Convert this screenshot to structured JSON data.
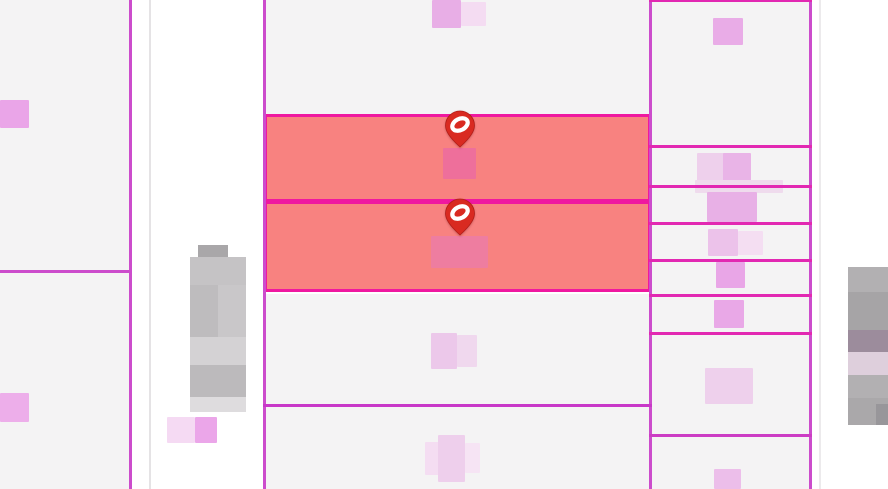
{
  "map": {
    "description": "cadastral-parcel-map",
    "canvas": {
      "width": 888,
      "height": 489,
      "background": "#ffffff"
    },
    "colors": {
      "parcel_fill": "#f4f3f4",
      "selected_fill": "#f88280",
      "selected_border": "#ef18a0",
      "boundary_purple": "#cc4ccc",
      "boundary_bright": "#e228b2",
      "faint_gray_line": "#e5e3e5",
      "marker_red": "#d92a21",
      "marker_outline": "#b01d18",
      "marker_glyph": "#ffffff"
    },
    "selected_count": 2,
    "parcels": [
      {
        "name": "parcel",
        "x": 0,
        "y": 0,
        "w": 129,
        "h": 270,
        "fill": "#f4f3f4",
        "selected": false
      },
      {
        "name": "parcel",
        "x": 0,
        "y": 273,
        "w": 129,
        "h": 216,
        "fill": "#f4f3f4",
        "selected": false
      },
      {
        "name": "parcel",
        "x": 266,
        "y": 0,
        "w": 383,
        "h": 114,
        "fill": "#f4f3f4",
        "selected": false
      },
      {
        "name": "selected-parcel",
        "x": 264,
        "y": 114,
        "w": 387,
        "h": 88,
        "fill": "#f88280",
        "selected": true,
        "border": "#ef18a0"
      },
      {
        "name": "selected-parcel",
        "x": 264,
        "y": 201,
        "w": 387,
        "h": 91,
        "fill": "#f88280",
        "selected": true,
        "border": "#ef18a0"
      },
      {
        "name": "parcel",
        "x": 266,
        "y": 294,
        "w": 383,
        "h": 110,
        "fill": "#f4f3f4",
        "selected": false
      },
      {
        "name": "parcel",
        "x": 266,
        "y": 407,
        "w": 383,
        "h": 82,
        "fill": "#f4f3f4",
        "selected": false
      },
      {
        "name": "parcel",
        "x": 652,
        "y": 2,
        "w": 157,
        "h": 143,
        "fill": "#f4f3f4",
        "selected": false
      },
      {
        "name": "parcel",
        "x": 652,
        "y": 148,
        "w": 157,
        "h": 37,
        "fill": "#f4f3f4",
        "selected": false
      },
      {
        "name": "parcel",
        "x": 652,
        "y": 188,
        "w": 157,
        "h": 34,
        "fill": "#f4f3f4",
        "selected": false
      },
      {
        "name": "parcel",
        "x": 652,
        "y": 225,
        "w": 157,
        "h": 34,
        "fill": "#f4f3f4",
        "selected": false
      },
      {
        "name": "parcel",
        "x": 652,
        "y": 262,
        "w": 157,
        "h": 32,
        "fill": "#f4f3f4",
        "selected": false
      },
      {
        "name": "parcel",
        "x": 652,
        "y": 297,
        "w": 157,
        "h": 35,
        "fill": "#f4f3f4",
        "selected": false
      },
      {
        "name": "parcel",
        "x": 652,
        "y": 335,
        "w": 157,
        "h": 99,
        "fill": "#f4f3f4",
        "selected": false
      },
      {
        "name": "parcel",
        "x": 652,
        "y": 437,
        "w": 157,
        "h": 52,
        "fill": "#f4f3f4",
        "selected": false
      }
    ],
    "boundary_lines": [
      {
        "name": "boundary-line",
        "x": 129,
        "y": 0,
        "w": 3,
        "h": 489,
        "color": "#cc4ccc"
      },
      {
        "name": "boundary-line-faint",
        "x": 149,
        "y": 0,
        "w": 2,
        "h": 489,
        "color": "#e5e3e5"
      },
      {
        "name": "boundary-line",
        "x": 263,
        "y": 0,
        "w": 3,
        "h": 489,
        "color": "#cc4ccc"
      },
      {
        "name": "boundary-line",
        "x": 649,
        "y": 0,
        "w": 3,
        "h": 489,
        "color": "#cc4ccc"
      },
      {
        "name": "boundary-line",
        "x": 809,
        "y": 0,
        "w": 3,
        "h": 489,
        "color": "#cc4ccc"
      },
      {
        "name": "boundary-line-faint",
        "x": 819,
        "y": 0,
        "w": 2,
        "h": 489,
        "color": "#eceaec"
      },
      {
        "name": "boundary-line",
        "x": 0,
        "y": 270,
        "w": 131,
        "h": 3,
        "color": "#cc4ccc"
      },
      {
        "name": "boundary-line",
        "x": 263,
        "y": 404,
        "w": 389,
        "h": 3,
        "color": "#c837c8"
      },
      {
        "name": "boundary-line",
        "x": 649,
        "y": 0,
        "w": 163,
        "h": 2,
        "color": "#e228b2"
      },
      {
        "name": "boundary-line",
        "x": 649,
        "y": 145,
        "w": 163,
        "h": 3,
        "color": "#e228b2"
      },
      {
        "name": "boundary-line",
        "x": 649,
        "y": 185,
        "w": 163,
        "h": 3,
        "color": "#e228b2"
      },
      {
        "name": "boundary-line",
        "x": 649,
        "y": 222,
        "w": 163,
        "h": 3,
        "color": "#e228b2"
      },
      {
        "name": "boundary-line",
        "x": 649,
        "y": 259,
        "w": 163,
        "h": 3,
        "color": "#e228b2"
      },
      {
        "name": "boundary-line",
        "x": 649,
        "y": 294,
        "w": 163,
        "h": 3,
        "color": "#e228b2"
      },
      {
        "name": "boundary-line",
        "x": 649,
        "y": 332,
        "w": 163,
        "h": 3,
        "color": "#e228b2"
      },
      {
        "name": "boundary-line",
        "x": 649,
        "y": 434,
        "w": 163,
        "h": 3,
        "color": "#cc3cc4"
      }
    ],
    "redacted_parcel_labels": [
      {
        "name": "parcel-label-redacted",
        "x": 0,
        "y": 100,
        "w": 29,
        "h": 28,
        "color": "#eaa5e8"
      },
      {
        "name": "parcel-label-redacted",
        "x": 0,
        "y": 393,
        "w": 29,
        "h": 29,
        "color": "#edaeea"
      },
      {
        "name": "parcel-label-redacted",
        "x": 432,
        "y": 0,
        "w": 29,
        "h": 28,
        "color": "#e8aee6"
      },
      {
        "name": "parcel-label-redacted",
        "x": 461,
        "y": 2,
        "w": 25,
        "h": 24,
        "color": "#f4dcf2"
      },
      {
        "name": "parcel-label-redacted",
        "x": 443,
        "y": 148,
        "w": 33,
        "h": 31,
        "color": "#ee6f9b"
      },
      {
        "name": "parcel-label-redacted",
        "x": 431,
        "y": 236,
        "w": 57,
        "h": 32,
        "color": "#ee7da0"
      },
      {
        "name": "parcel-label-redacted",
        "x": 431,
        "y": 333,
        "w": 26,
        "h": 36,
        "color": "#ecc8ea"
      },
      {
        "name": "parcel-label-redacted",
        "x": 457,
        "y": 335,
        "w": 20,
        "h": 32,
        "color": "#f0d8ee"
      },
      {
        "name": "parcel-label-redacted",
        "x": 425,
        "y": 442,
        "w": 14,
        "h": 33,
        "color": "#f4ddf2"
      },
      {
        "name": "parcel-label-redacted",
        "x": 438,
        "y": 435,
        "w": 27,
        "h": 47,
        "color": "#eecfec"
      },
      {
        "name": "parcel-label-redacted",
        "x": 465,
        "y": 443,
        "w": 15,
        "h": 30,
        "color": "#f6e4f4"
      },
      {
        "name": "parcel-label-redacted",
        "x": 713,
        "y": 18,
        "w": 30,
        "h": 27,
        "color": "#e9ace7"
      },
      {
        "name": "parcel-label-redacted",
        "x": 697,
        "y": 153,
        "w": 27,
        "h": 30,
        "color": "#eed0ec"
      },
      {
        "name": "parcel-label-redacted",
        "x": 723,
        "y": 153,
        "w": 28,
        "h": 31,
        "color": "#e9b4e7"
      },
      {
        "name": "parcel-label-redacted",
        "x": 695,
        "y": 180,
        "w": 88,
        "h": 13,
        "color": "#efdbed"
      },
      {
        "name": "parcel-label-redacted",
        "x": 707,
        "y": 192,
        "w": 50,
        "h": 30,
        "color": "#e8b0e6"
      },
      {
        "name": "parcel-label-redacted",
        "x": 708,
        "y": 229,
        "w": 30,
        "h": 27,
        "color": "#ecc2ea"
      },
      {
        "name": "parcel-label-redacted",
        "x": 738,
        "y": 231,
        "w": 25,
        "h": 24,
        "color": "#f4def2"
      },
      {
        "name": "parcel-label-redacted",
        "x": 716,
        "y": 262,
        "w": 29,
        "h": 26,
        "color": "#e9a6e7"
      },
      {
        "name": "parcel-label-redacted",
        "x": 714,
        "y": 300,
        "w": 30,
        "h": 28,
        "color": "#e9a8e7"
      },
      {
        "name": "parcel-label-redacted",
        "x": 705,
        "y": 368,
        "w": 48,
        "h": 36,
        "color": "#eed0ec"
      },
      {
        "name": "parcel-label-redacted",
        "x": 714,
        "y": 469,
        "w": 27,
        "h": 20,
        "color": "#ecbeea"
      },
      {
        "name": "parcel-label-redacted",
        "x": 167,
        "y": 417,
        "w": 28,
        "h": 26,
        "color": "#f5daf3"
      },
      {
        "name": "parcel-label-redacted",
        "x": 195,
        "y": 417,
        "w": 22,
        "h": 26,
        "color": "#eba6e9"
      }
    ],
    "redacted_text_blocks": [
      {
        "name": "redacted-text-block",
        "x": 198,
        "y": 245,
        "w": 30,
        "h": 12,
        "color": "#a9a7a9"
      },
      {
        "name": "redacted-text-block",
        "x": 190,
        "y": 257,
        "w": 56,
        "h": 28,
        "color": "#c5c3c5"
      },
      {
        "name": "redacted-text-block",
        "x": 190,
        "y": 285,
        "w": 56,
        "h": 52,
        "color": "#c9c7c9"
      },
      {
        "name": "redacted-text-block",
        "x": 190,
        "y": 285,
        "w": 28,
        "h": 52,
        "color": "#bebcbe"
      },
      {
        "name": "redacted-text-block",
        "x": 190,
        "y": 337,
        "w": 56,
        "h": 28,
        "color": "#d4d2d4"
      },
      {
        "name": "redacted-text-block",
        "x": 190,
        "y": 365,
        "w": 56,
        "h": 32,
        "color": "#bcbabc"
      },
      {
        "name": "redacted-text-block",
        "x": 190,
        "y": 397,
        "w": 56,
        "h": 15,
        "color": "#dedcde"
      },
      {
        "name": "redacted-text-block",
        "x": 848,
        "y": 267,
        "w": 40,
        "h": 25,
        "color": "#b2b0b2"
      },
      {
        "name": "redacted-text-block",
        "x": 848,
        "y": 292,
        "w": 40,
        "h": 38,
        "color": "#a6a4a6"
      },
      {
        "name": "redacted-text-block",
        "x": 848,
        "y": 330,
        "w": 40,
        "h": 22,
        "color": "#9c8c9c"
      },
      {
        "name": "redacted-text-block",
        "x": 848,
        "y": 352,
        "w": 40,
        "h": 23,
        "color": "#decfdc"
      },
      {
        "name": "redacted-text-block",
        "x": 848,
        "y": 375,
        "w": 40,
        "h": 23,
        "color": "#b2b0b2"
      },
      {
        "name": "redacted-text-block",
        "x": 848,
        "y": 398,
        "w": 40,
        "h": 27,
        "color": "#aaa8aa"
      },
      {
        "name": "redacted-text-block",
        "x": 876,
        "y": 404,
        "w": 12,
        "h": 21,
        "color": "#98969a"
      }
    ],
    "markers": [
      {
        "name": "location-pin",
        "x": 444,
        "y": 110
      },
      {
        "name": "location-pin",
        "x": 444,
        "y": 198
      }
    ]
  }
}
